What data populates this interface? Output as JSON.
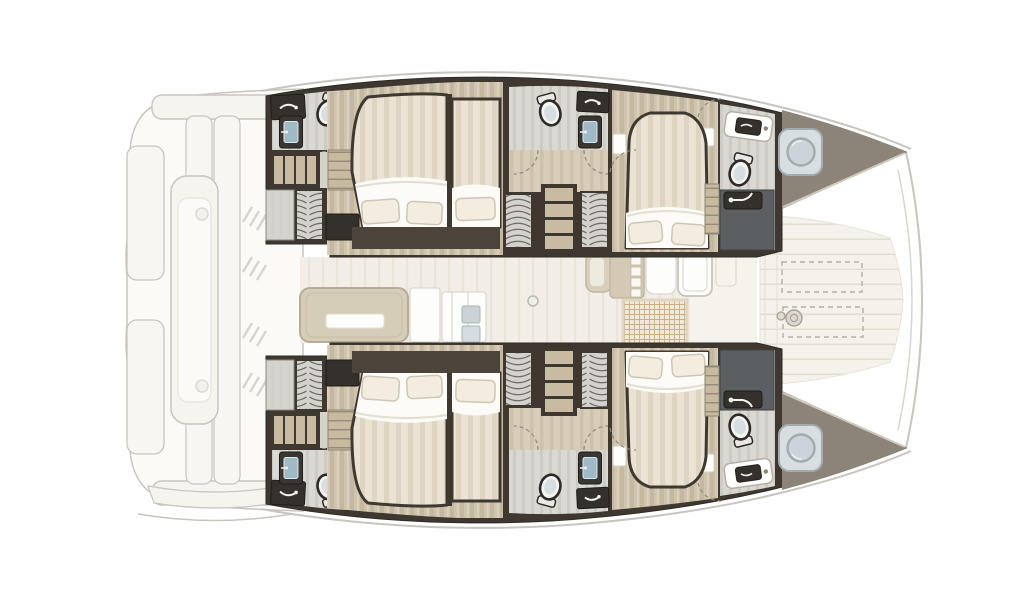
{
  "canvas": {
    "width": 1024,
    "height": 600,
    "background": "#FFFFFF"
  },
  "colors": {
    "background": "#FFFFFF",
    "outline_faint": "#C8C5BF",
    "deck_faint_fill": "#F6F4EF",
    "deck_faint_inner": "#FBFAF6",
    "wall_dark": "#3E3831",
    "wall_under_bed": "#4A443B",
    "charcoal_stall": "#5C5F62",
    "counter_dark": "#34312C",
    "wood_base": "#CFC4AE",
    "wood_stripe": "#C4B8A0",
    "wood_light": "#DCD2BF",
    "walkway_base": "#D7CDB9",
    "walkway_stripe": "#CCC1AB",
    "tile_base": "#DAD8D2",
    "tile_stripe": "#CDCBC4",
    "gray_block": "#D4D3CE",
    "coil_bg": "#D3D2CD",
    "coil_line": "#6E6A62",
    "shelf_tan": "#C8BA9E",
    "shelf_line": "#8F8675",
    "stairs_tread": "#C9BBA1",
    "bed_base": "#EAE3D3",
    "bed_stripe": "#DDD5C1",
    "duvet": "#FCFBF7",
    "pillow": "#F2EDDF",
    "pillow_shadow": "#CEC7B5",
    "toilet_body": "#F3F3F0",
    "toilet_rim": "#2E2B27",
    "toilet_lid": "#D7DEE1",
    "basin_blue": "#9FB9C6",
    "saloon_floor": "#F2EEE7",
    "saloon_stripe": "#EAE5DB",
    "sofa": "#D6CDB9",
    "sofa_border": "#B7AD97",
    "white_furniture": "#FDFDFB",
    "furniture_line": "#D5D1C8",
    "grid_bg": "#F0E9DA",
    "grid_line": "#C9AF85",
    "deck_cream": "#F5F2EB",
    "deck_slat": "#E2DDD2",
    "dash_line": "#B3AFA6",
    "bow_taupe": "#8C8478",
    "bow_edge_light": "#CFC9BE",
    "hatch_panel": "#D5DEE1",
    "hatch_stroke": "#A2ACB0",
    "hatch_circle": "#CBD5D9",
    "door_arc": "#8F897E"
  },
  "plan": {
    "zones": [
      {
        "name": "aft-deck"
      },
      {
        "name": "saloon"
      },
      {
        "name": "forward-cockpit"
      },
      {
        "name": "foredeck"
      },
      {
        "name": "starboard-hull",
        "rooms": [
          "aft-head",
          "companionway-aft",
          "aft-cabin",
          "mid-head",
          "companionway-mid",
          "forward-cabin",
          "forward-head",
          "bow-locker"
        ]
      },
      {
        "name": "port-hull",
        "rooms": [
          "aft-head",
          "companionway-aft",
          "aft-cabin",
          "mid-head",
          "companionway-mid",
          "forward-cabin",
          "forward-head",
          "bow-locker"
        ]
      }
    ]
  }
}
